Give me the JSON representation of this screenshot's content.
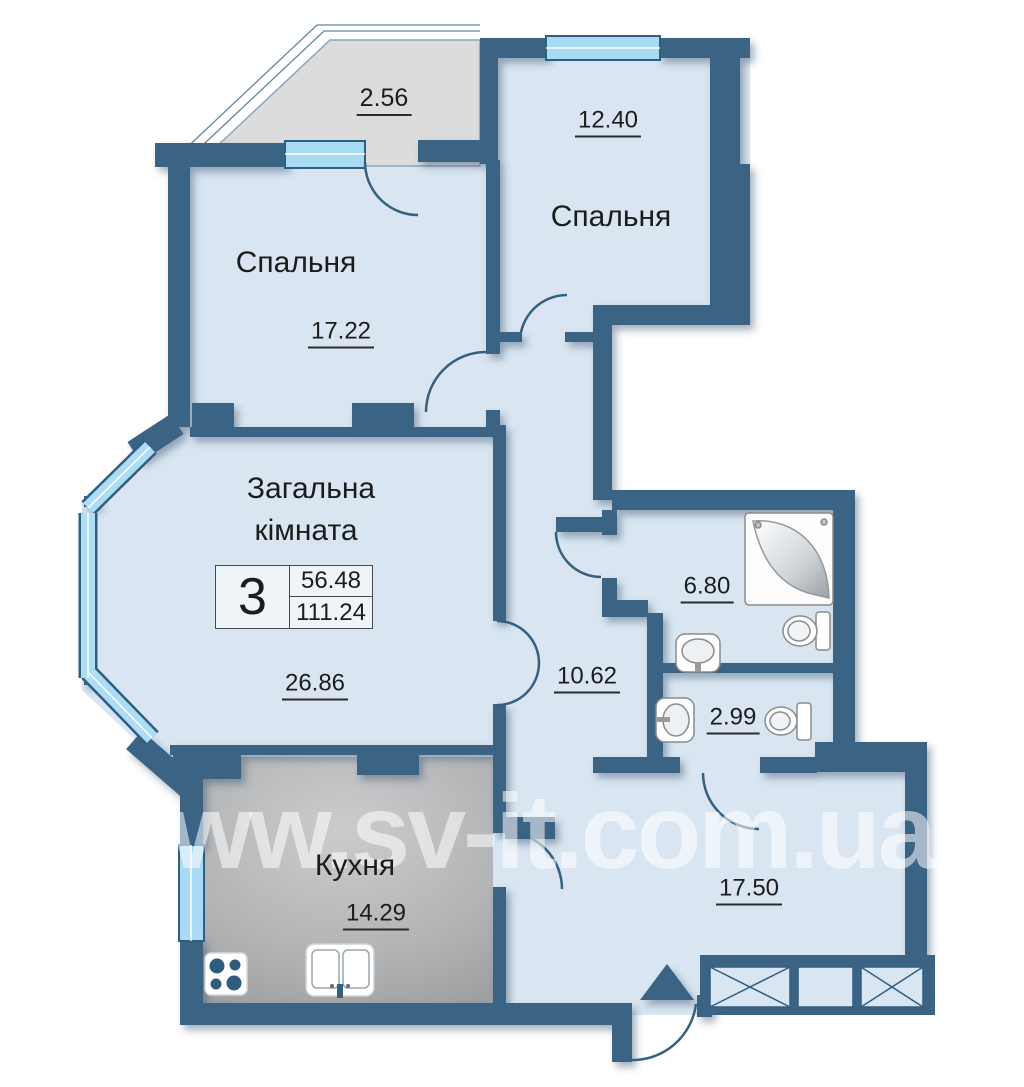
{
  "plan": {
    "watermark": "www.sv-it.com.ua",
    "info_box": {
      "rooms_count": "3",
      "living_area": "56.48",
      "total_area": "111.24"
    },
    "rooms": {
      "balcony": {
        "area": "2.56"
      },
      "bedroom_left": {
        "name": "Спальня",
        "area": "17.22"
      },
      "bedroom_right": {
        "name": "Спальня",
        "area": "12.40"
      },
      "living": {
        "name_line1": "Загальна",
        "name_line2": "кімната",
        "area": "26.86"
      },
      "corridor": {
        "area": "10.62"
      },
      "bathroom": {
        "area": "6.80"
      },
      "wc": {
        "area": "2.99"
      },
      "kitchen": {
        "name": "Кухня",
        "area": "14.29"
      },
      "hallway": {
        "area": "17.50"
      }
    },
    "colors": {
      "wall": "#3A6384",
      "room_fill": "#D9E6F1",
      "window": "#A9DAF4",
      "balcony_floor": "#DCDCDD",
      "kitchen_floor_dark": "#97999B",
      "kitchen_floor_light": "#CBCCCD",
      "label_text": "#1C1C1C",
      "watermark": "rgba(255,255,255,0.55)"
    }
  }
}
